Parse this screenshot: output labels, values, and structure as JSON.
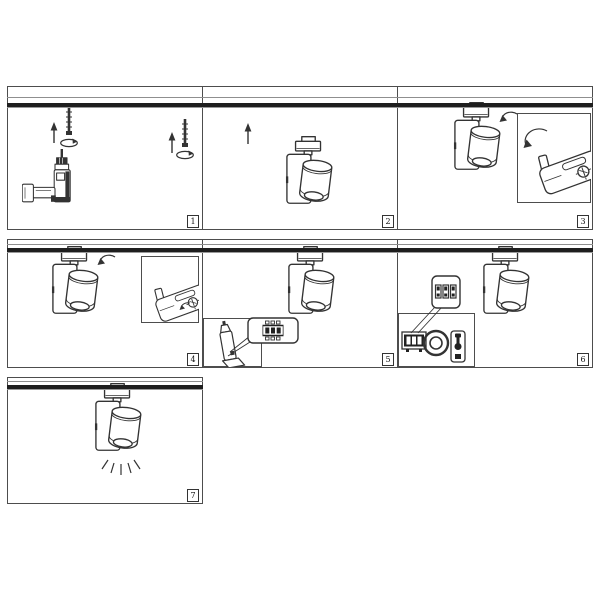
{
  "sheet": {
    "type": "installation-instruction-diagram",
    "panel_count": 7
  },
  "colors": {
    "background": "#ffffff",
    "line_art": "#333333",
    "panel_border": "#4d4d4d",
    "track_band": "#1e1e1e",
    "track_line": "#8f8f8f",
    "badge_text": "#111111"
  },
  "panels": [
    {
      "number": "1",
      "icons": [
        "up-arrow-icon",
        "mounting-screw-icon",
        "rotation-ellipse-icon",
        "power-drill-icon",
        "ceiling-track"
      ]
    },
    {
      "number": "2",
      "icons": [
        "up-arrow-icon",
        "track-light-fixture-icon",
        "ceiling-track"
      ]
    },
    {
      "number": "3",
      "icons": [
        "track-light-fixture-icon",
        "rotate-arrow-icon",
        "adapter-latch-detail-inset",
        "ceiling-track"
      ]
    },
    {
      "number": "4",
      "icons": [
        "track-light-fixture-icon",
        "rotate-arrow-icon",
        "adapter-screw-detail-inset",
        "ceiling-track"
      ]
    },
    {
      "number": "5",
      "icons": [
        "track-light-fixture-icon",
        "fixture-profile-inset",
        "dip-switch-callout",
        "ceiling-track"
      ]
    },
    {
      "number": "6",
      "icons": [
        "track-light-fixture-icon",
        "dip-switch-callout",
        "dip-switch-module-icon",
        "rotary-dial-icon",
        "toggle-switch-icon",
        "ceiling-track"
      ]
    },
    {
      "number": "7",
      "icons": [
        "track-light-fixture-icon",
        "light-rays-icon",
        "ceiling-track"
      ]
    }
  ]
}
